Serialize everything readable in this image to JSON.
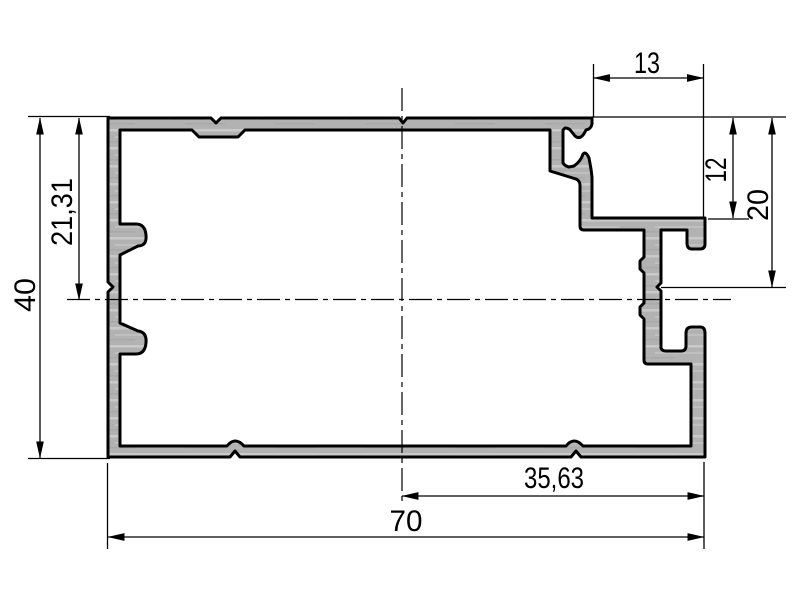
{
  "drawing": {
    "type": "profile-cross-section",
    "background_color": "#ffffff",
    "profile_fill": "#b2b2b2",
    "line_color": "#000000",
    "dimensions": {
      "overall_width": "70",
      "overall_height": "40",
      "axis_offset_from_top": "21,31",
      "rebate_width": "13",
      "rebate_depth": "12",
      "channel_axis_depth": "20",
      "right_section_width": "35,63"
    }
  }
}
